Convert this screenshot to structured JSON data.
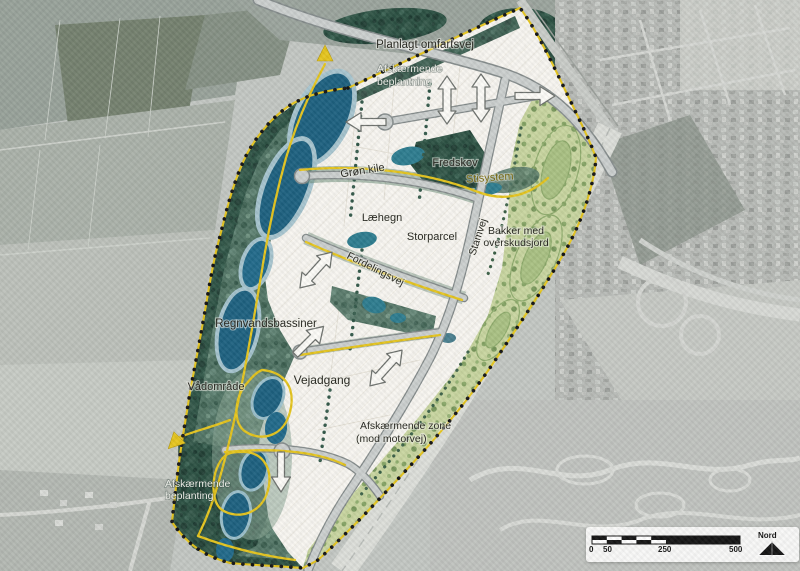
{
  "map": {
    "labels": {
      "omfartsvej": "Planlagt omfartsvej",
      "beplantning_top_1": "Afskærmende",
      "beplantning_top_2": "beplantning",
      "groen_kile": "Grøn kile",
      "fredskov": "Fredskov",
      "stisystem": "Stisystem",
      "laehegn": "Læhegn",
      "storparcel": "Storparcel",
      "bakker_1": "Bakker med",
      "bakker_2": "overskudsjord",
      "stamvej": "Stamvej",
      "fordelingsvej": "Fordelingsvej",
      "regnvandsbassiner": "Regnvandsbassiner",
      "vaadomraade": "Vådområde",
      "vejadgang": "Vejadgang",
      "zone_1": "Afskærmende zone",
      "zone_2": "(mod motorvej)",
      "beplanting_sw_1": "Afskærmende",
      "beplanting_sw_2": "beplanting"
    },
    "scalebar": {
      "t0": "0",
      "t1": "50",
      "t2": "250",
      "t3": "500",
      "north": "Nord"
    },
    "colors": {
      "pond_blue": "#1e6180",
      "corridor_green": "#527565",
      "forest_green": "#2c5143",
      "strip_green": "#c8d5a0",
      "path_yellow": "#e5c51e",
      "road_gray": "#cbcfce",
      "boundary_dot": "#141414",
      "parcel_white": "#f8f6f1"
    }
  }
}
